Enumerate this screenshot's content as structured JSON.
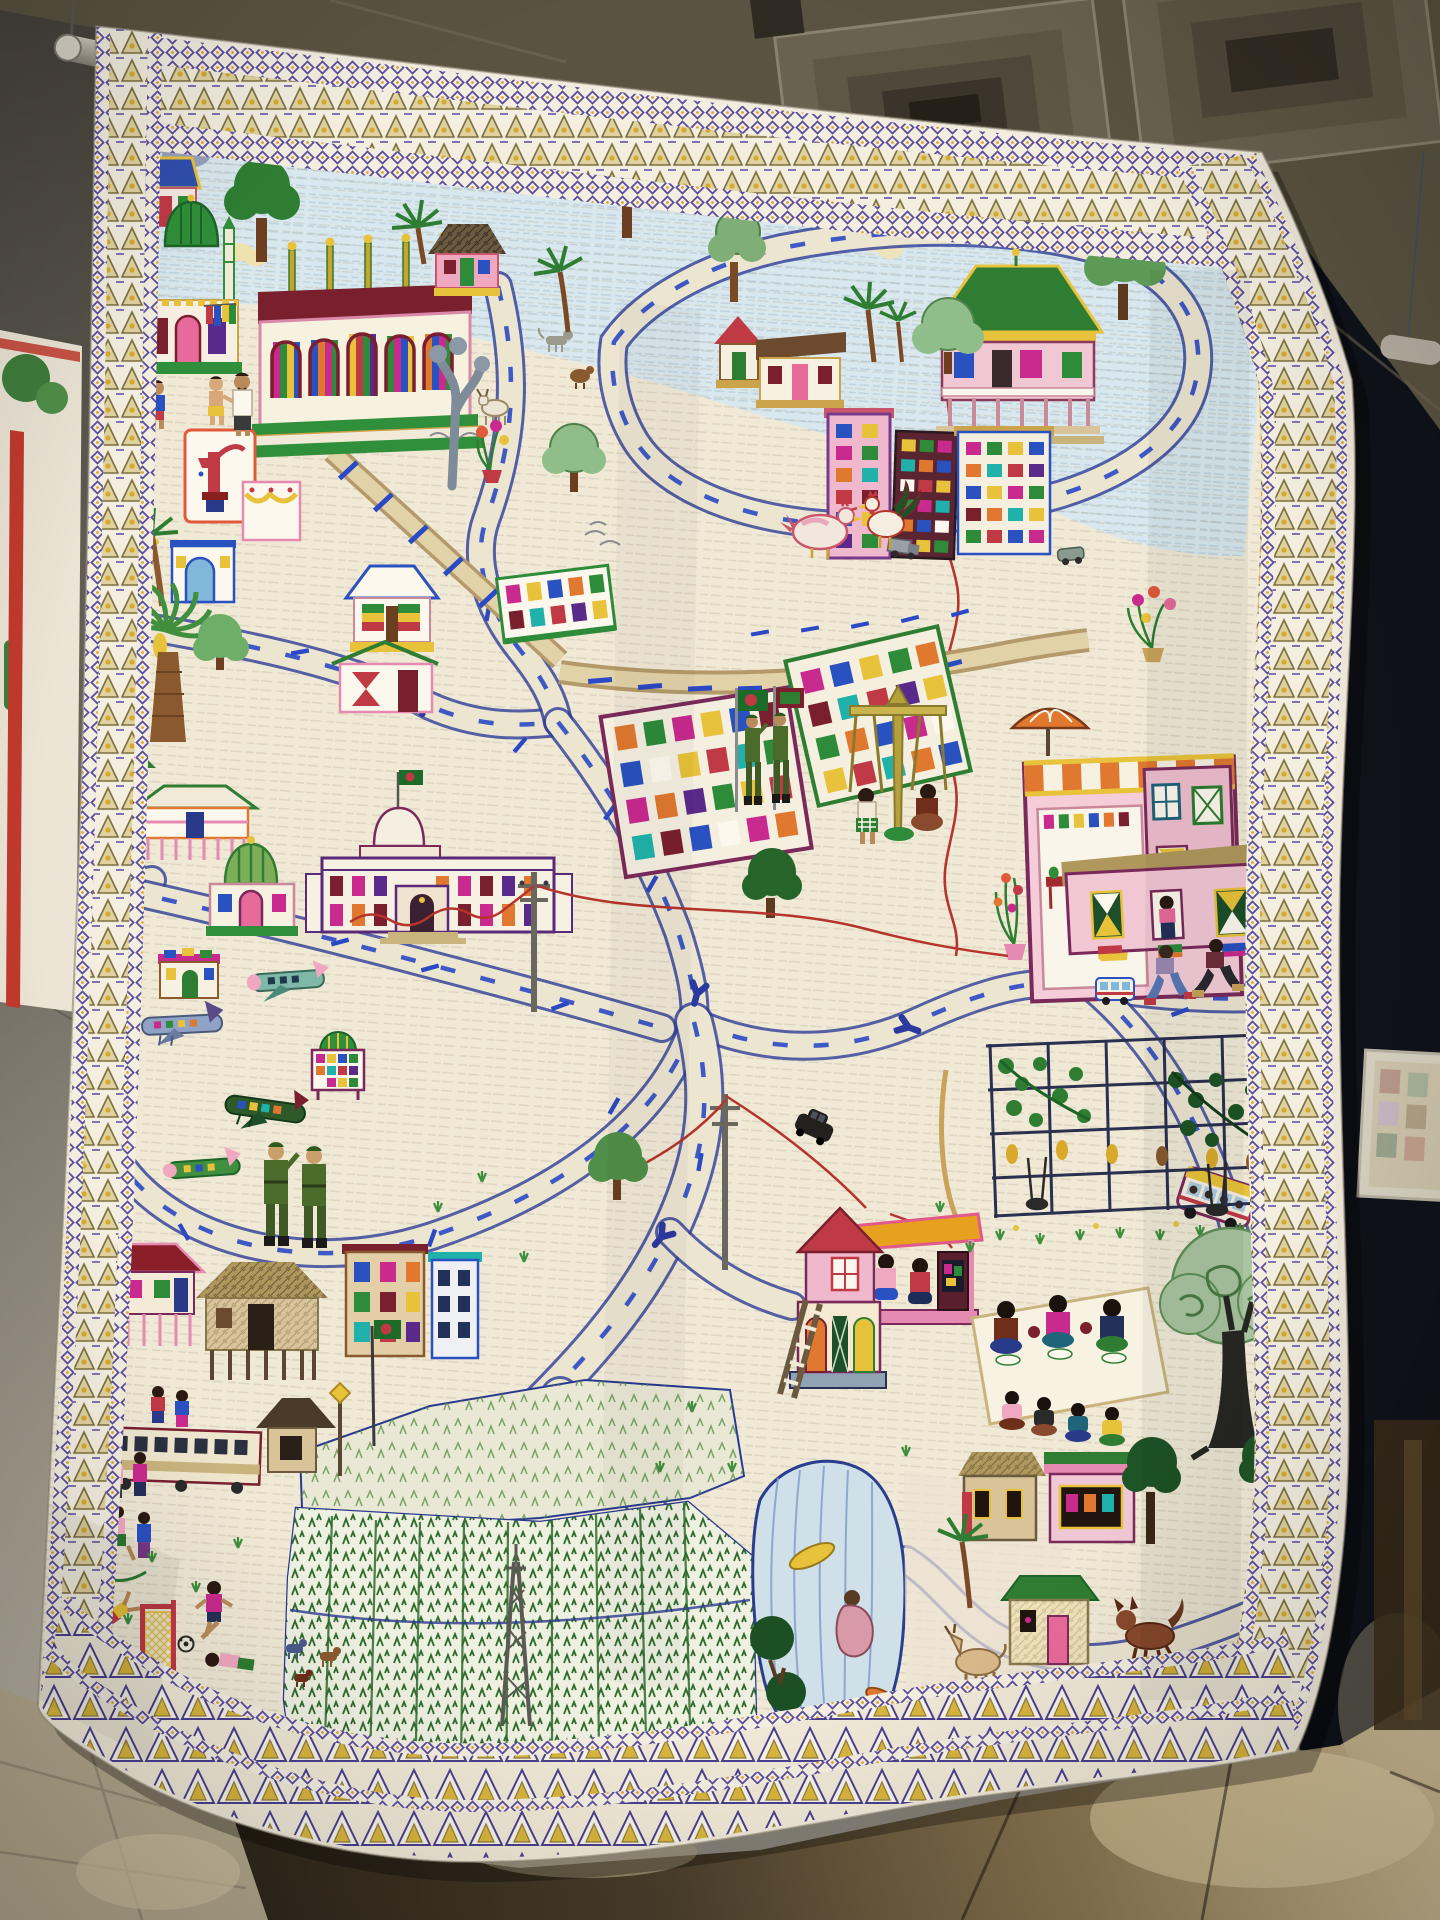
{
  "scene": {
    "type": "photograph",
    "setting": "museum gallery interior with a large suspended textile artwork",
    "subject": "hand-embroidered nakshi-kantha story quilt depicting a stitched map of a Bangladeshi town",
    "lighting": "indoor gallery light, dark wall at right, warm reflections on tiled floor"
  },
  "palette": {
    "ceiling": "#5a5341",
    "ceilingDark": "#3e3a2f",
    "ventDark": "#241f17",
    "wallLeft": "#6e6a60",
    "wallRight": "#0f1219",
    "floorLeft": "#b3a78c",
    "rod": "#b7b1a3",
    "neighborQuilt": "#ece5d6",
    "neighborStripe": "#c23a2c",
    "neighborGreen": "#3f7d3c",
    "fabric": "#f0e9d6",
    "sky": "#d9e8ee",
    "borderPurple": "#5b4c9e",
    "borderOlive": "#8a7c42",
    "borderGold": "#d9a92c",
    "roadEdge": "#2e3c96",
    "roadFill": "#ece5d0",
    "water": "#cfe0e8",
    "paddyGreen": "#2f6b2f",
    "treeGreen": "#2f7d33",
    "maroon": "#7a1f2e",
    "brickRed": "#c03a46",
    "magenta": "#c92a8e",
    "marigold": "#e8c23a",
    "armyGreen": "#4a6b2a",
    "flagGreen": "#1d6b28",
    "pinkHouse": "#f2c7d4",
    "shopPink": "#f4cdd8",
    "palaceWhite": "#f7f1e4"
  },
  "artwork": {
    "kind": "embroidered story quilt (kantha), white ground covered in running-stitch texture",
    "borders": [
      "thin purple diamond strip",
      "olive and gold triangle band",
      "second purple diamond strip",
      "large purple-gold triangle band along the bottom hem"
    ],
    "motifs": [
      {
        "id": "sky-band",
        "label": "pale blue sky with appliqued clouds and a small aeroplane"
      },
      {
        "id": "mosque-green-dome",
        "label": "mosque with striped green dome and twin minarets"
      },
      {
        "id": "madrasa",
        "label": "long white building with maroon roof, five striped arch windows and gold finials"
      },
      {
        "id": "pink-house",
        "label": "pink house with cross-hatched thatch roof"
      },
      {
        "id": "pavilion",
        "label": "green-roofed rest pavilion on posts"
      },
      {
        "id": "city-towers",
        "label": "tall apartment towers with multicoloured windows"
      },
      {
        "id": "railway",
        "label": "tan railway band with blue sleepers"
      },
      {
        "id": "roads",
        "label": "winding roads edged in blue with dashed centre lines and Y junctions"
      },
      {
        "id": "water-pump",
        "label": "framed panel with red hand tube-well"
      },
      {
        "id": "rainbow-house",
        "label": "house with rainbow-striped shutters"
      },
      {
        "id": "bowtie-house",
        "label": "white house with red bow-tie windows"
      },
      {
        "id": "school",
        "label": "tilted school block with rows of coloured windows"
      },
      {
        "id": "palace",
        "label": "palace with dome, national flag and rows of purple windows"
      },
      {
        "id": "shrine",
        "label": "small shrine with green striped dome"
      },
      {
        "id": "stilt-house",
        "label": "long house raised on stilts"
      },
      {
        "id": "diamond-buildings",
        "label": "two tilted factory blocks with mosaics of coloured windows"
      },
      {
        "id": "swing-set",
        "label": "two figures on a double swing"
      },
      {
        "id": "soldier-flags",
        "label": "two soldiers saluting beside flag poles"
      },
      {
        "id": "soldiers-large",
        "label": "two larger soldiers in green uniform near the airfield"
      },
      {
        "id": "aeroplanes",
        "label": "four embroidered aeroplanes of teal, grey, dark-green and green-pink"
      },
      {
        "id": "shop-complex",
        "label": "large pink shop with striped awning, umbrella, shopkeeper and parked car"
      },
      {
        "id": "window-women",
        "label": "women at windows of a long pink house"
      },
      {
        "id": "pedestrians",
        "label": "two pedestrians walking along the road"
      },
      {
        "id": "vegetable-garden",
        "label": "trellis garden with vines, hanging gourds and swings"
      },
      {
        "id": "tv-hut",
        "label": "family watching television under an orange-roofed hut"
      },
      {
        "id": "ladder-house",
        "label": "two-storey house with ladder and arched doors"
      },
      {
        "id": "picnic-mat",
        "label": "three people eating on a white mat with seated audience below"
      },
      {
        "id": "big-tree",
        "label": "large shade tree with dark trunk and scribbled canopy"
      },
      {
        "id": "bus",
        "label": "yellow-roofed bus full of passengers"
      },
      {
        "id": "vehicles",
        "label": "small cars and a truck on the roads"
      },
      {
        "id": "train-building",
        "label": "long low building with a row of dark windows"
      },
      {
        "id": "flag-bangladesh",
        "label": "green flag with red disc on a pole"
      },
      {
        "id": "children-skipping",
        "label": "children playing skipping rope"
      },
      {
        "id": "football",
        "label": "children playing football with goal and ball"
      },
      {
        "id": "somersaults",
        "label": "children tumbling and crawling"
      },
      {
        "id": "rice-paddies",
        "label": "large panels of green rice paddy rows"
      },
      {
        "id": "pond",
        "label": "blue pond with yellow and orange fish and a bathing figure"
      },
      {
        "id": "goat",
        "label": "tan goat grazing"
      },
      {
        "id": "dog",
        "label": "red-brown dog with bushy tail"
      },
      {
        "id": "hen-rooster",
        "label": "white hen and colourful rooster"
      },
      {
        "id": "palms",
        "label": "coconut and banana palms"
      },
      {
        "id": "power-lines",
        "label": "electric poles with wavy red wires"
      },
      {
        "id": "flower-pots",
        "label": "potted flowering plants"
      },
      {
        "id": "houses-bottom-right",
        "label": "village houses near pond with goat and dog"
      }
    ]
  },
  "environment": {
    "ceiling": "olive suspended ceiling with two recessed square air vents",
    "hanging_rod": "grey pole from which the quilt is suspended on wires",
    "neighbor_textile": "edge of a second quilt with red stripe and green trees at far left",
    "framed_label": "small framed display on the dark right wall",
    "floor": "beige ceramic tiles catching warm light at bottom right"
  }
}
